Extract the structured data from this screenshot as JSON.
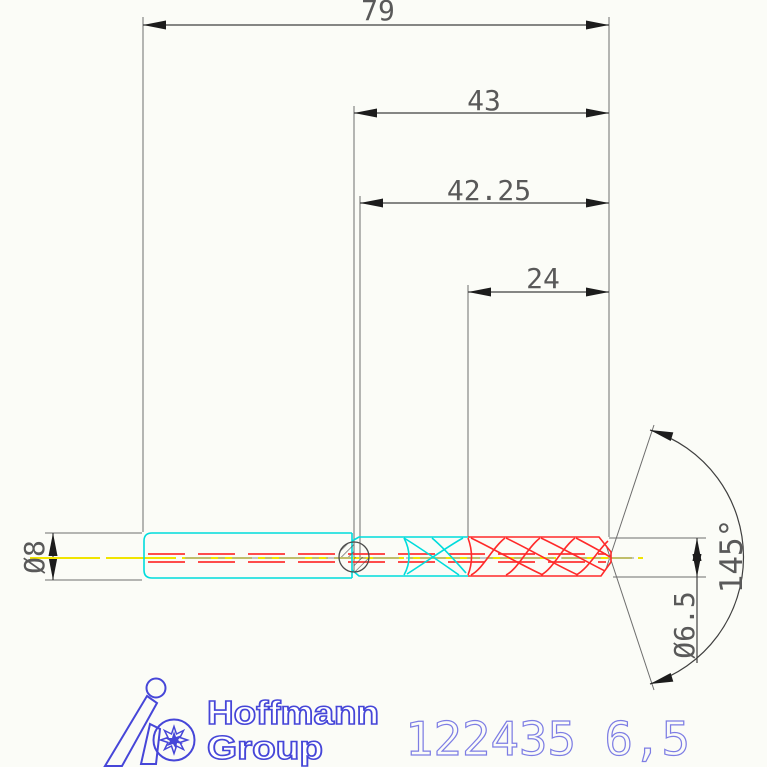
{
  "drawing": {
    "dims": {
      "overall_length": "79",
      "flute_length": "43",
      "secondary_length": "42.25",
      "step_length": "24",
      "shank_diameter": "Ø8",
      "cutting_diameter": "Ø6.5",
      "point_angle": "145°"
    },
    "footer": {
      "brand_line1": "Hoffmann",
      "brand_line2": "Group",
      "part_number": "122435 6,5"
    },
    "colors": {
      "dimension_lines": "#3f3f3f",
      "extension_lines": "#6e6e6e",
      "dimension_text": "#595959",
      "arrow_black": "#1c1c1c",
      "shank_cyan": "#00dcdc",
      "flute_red": "#ff2a2a",
      "coolant_red": "#ff3333",
      "centerline_yellow": "#f0e400",
      "centerline_gray": "#a2a6aa",
      "hatch_gray": "#4a4a4a",
      "brand_blue": "#4646d8",
      "part_number_blue": "#7d7de4"
    }
  }
}
